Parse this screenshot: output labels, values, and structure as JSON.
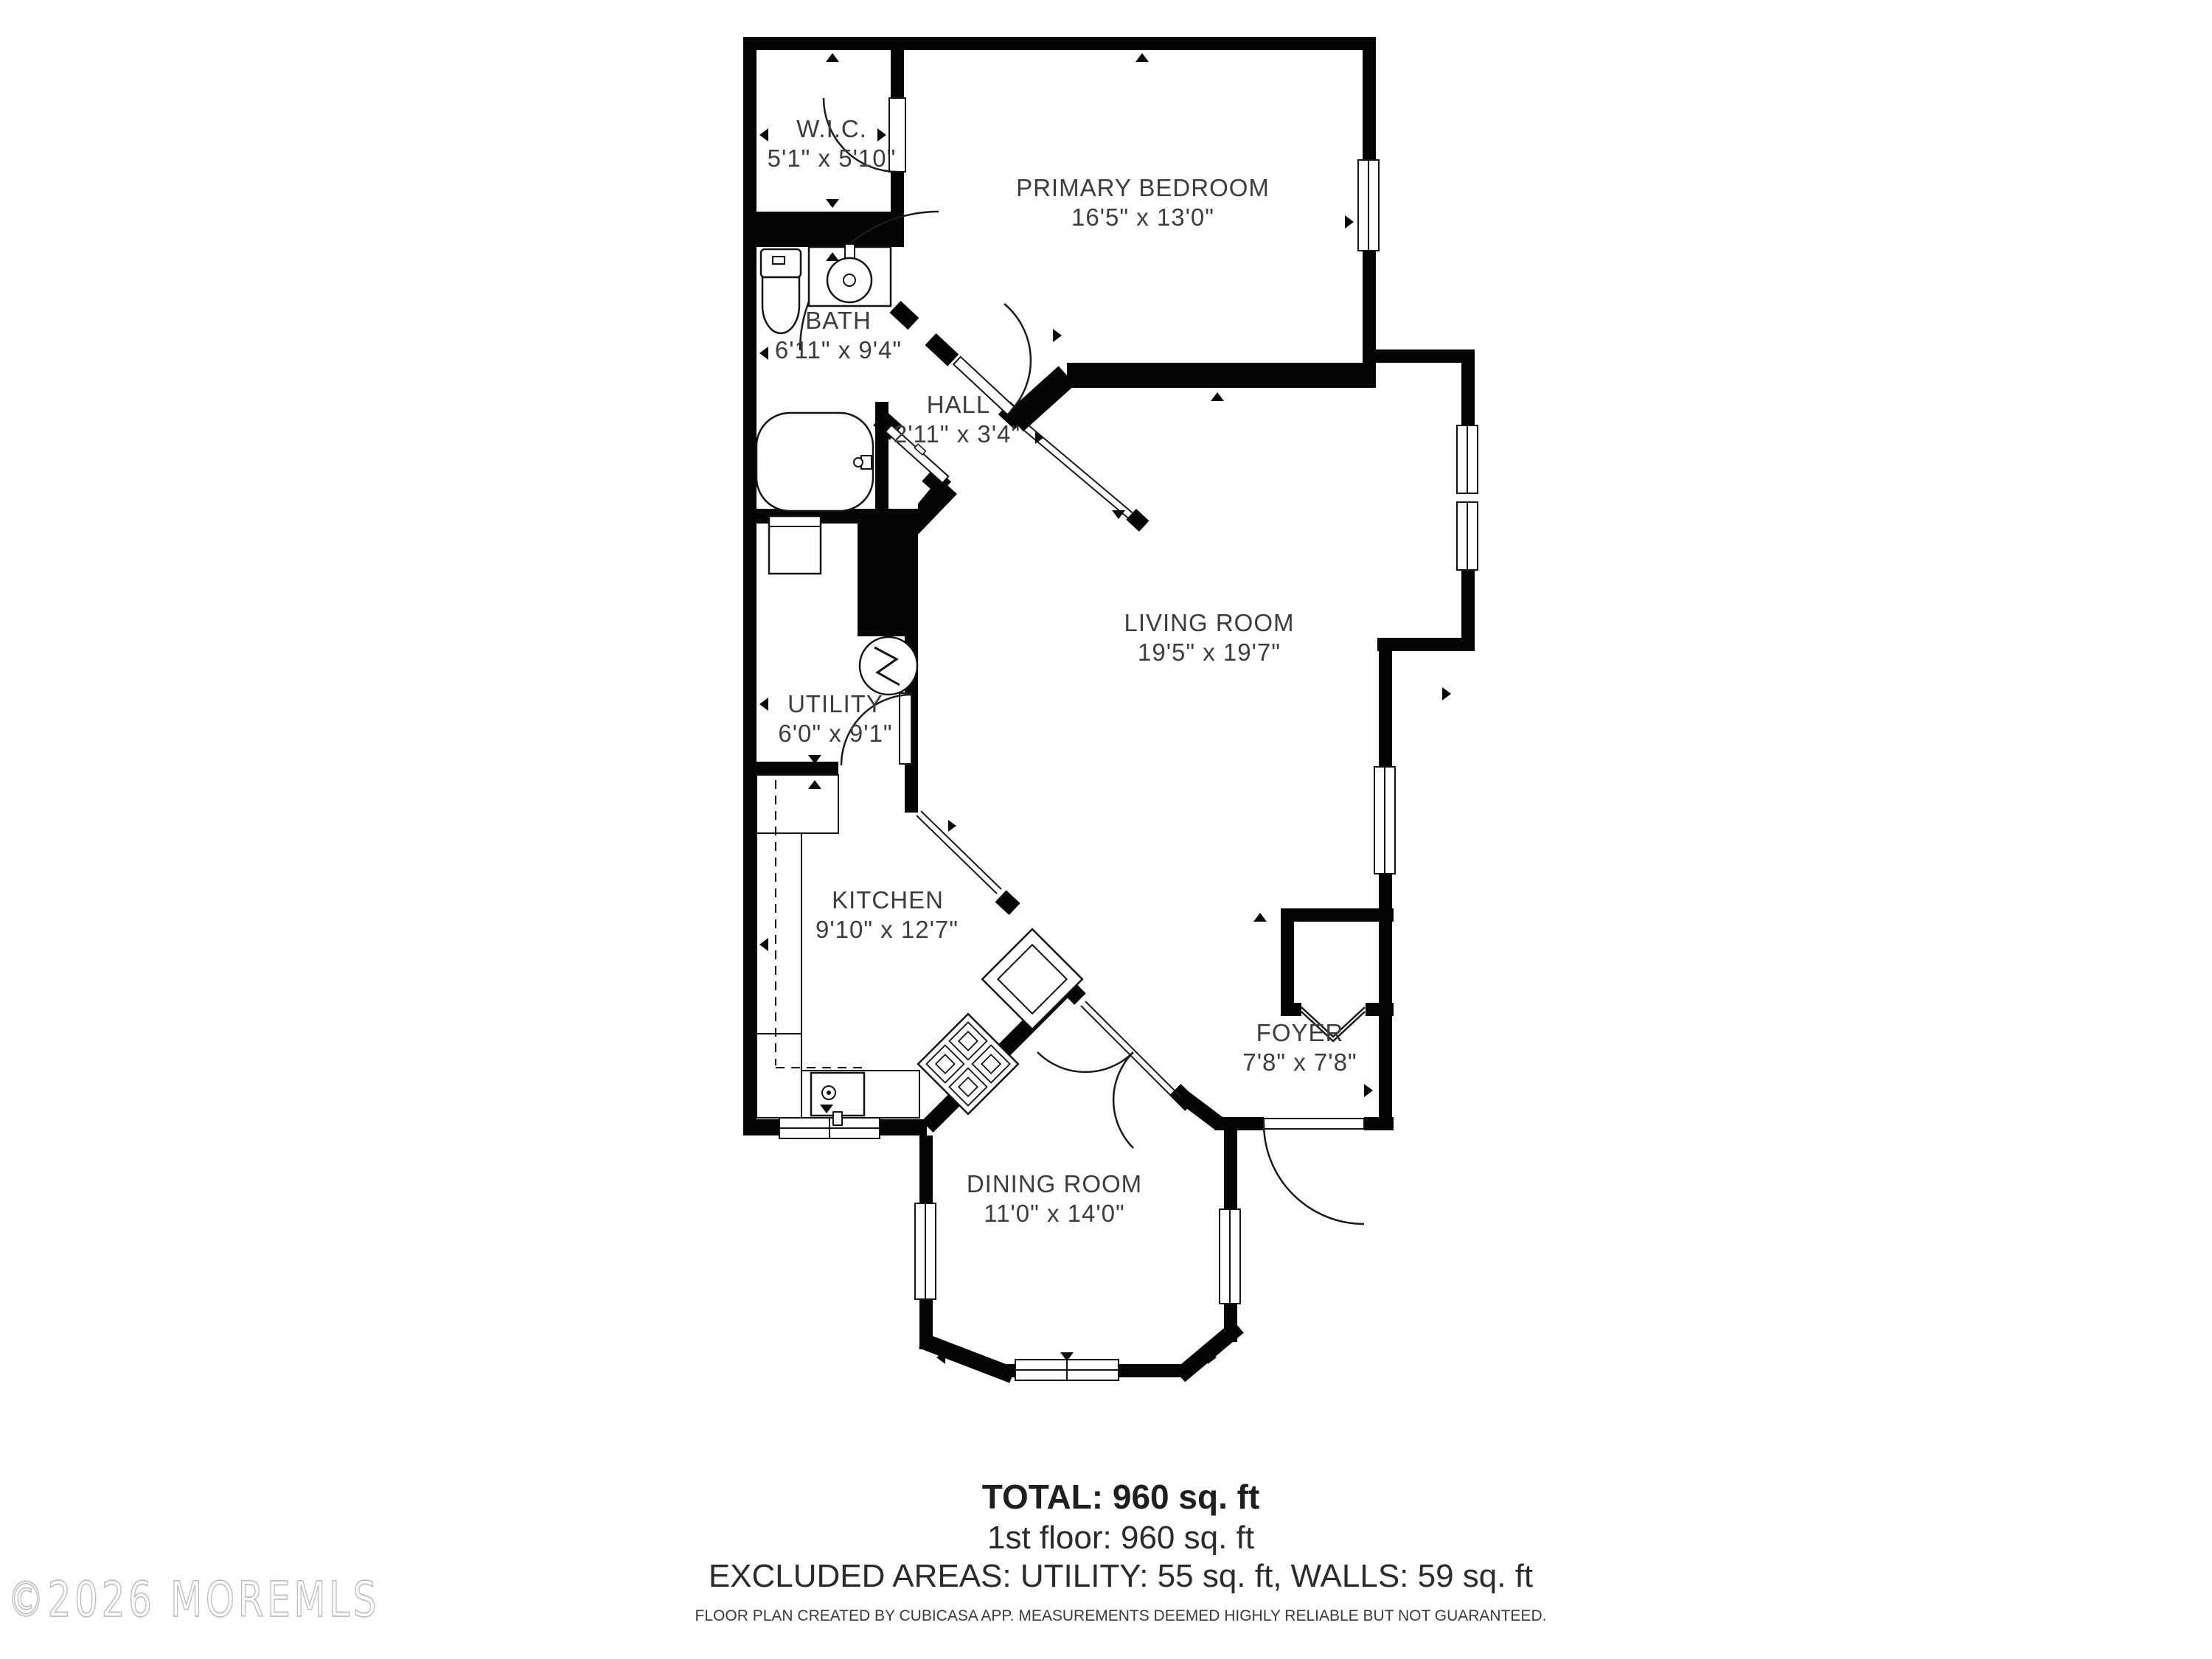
{
  "plan": {
    "rooms": [
      {
        "id": "wic",
        "name": "W.I.C.",
        "dims": "5'1\" x 5'10\""
      },
      {
        "id": "bedroom",
        "name": "PRIMARY BEDROOM",
        "dims": "16'5\" x 13'0\""
      },
      {
        "id": "bath",
        "name": "BATH",
        "dims": "6'11\" x 9'4\""
      },
      {
        "id": "hall",
        "name": "HALL",
        "dims": "2'11\" x 3'4\""
      },
      {
        "id": "living",
        "name": "LIVING ROOM",
        "dims": "19'5\" x 19'7\""
      },
      {
        "id": "utility",
        "name": "UTILITY",
        "dims": "6'0\" x 9'1\""
      },
      {
        "id": "kitchen",
        "name": "KITCHEN",
        "dims": "9'10\" x 12'7\""
      },
      {
        "id": "foyer",
        "name": "FOYER",
        "dims": "7'8\" x 7'8\""
      },
      {
        "id": "dining",
        "name": "DINING ROOM",
        "dims": "11'0\" x 14'0\""
      }
    ],
    "fixtures": [
      "toilet",
      "bathroom-sink",
      "bathtub",
      "washer",
      "water-heater",
      "kitchen-sink",
      "stove",
      "refrigerator"
    ],
    "footer": {
      "total": "TOTAL: 960 sq. ft",
      "floor": "1st floor: 960 sq. ft",
      "excluded": "EXCLUDED AREAS: UTILITY: 55 sq. ft, WALLS: 59 sq. ft",
      "disclaimer": "FLOOR PLAN CREATED BY CUBICASA APP. MEASUREMENTS DEEMED HIGHLY RELIABLE BUT NOT GUARANTEED."
    },
    "watermark": "©2026 MOREMLS",
    "colors": {
      "wall": "#050505",
      "text": "#3d3d3d",
      "watermark_stroke": "#bdbdbd",
      "background": "#ffffff"
    }
  }
}
